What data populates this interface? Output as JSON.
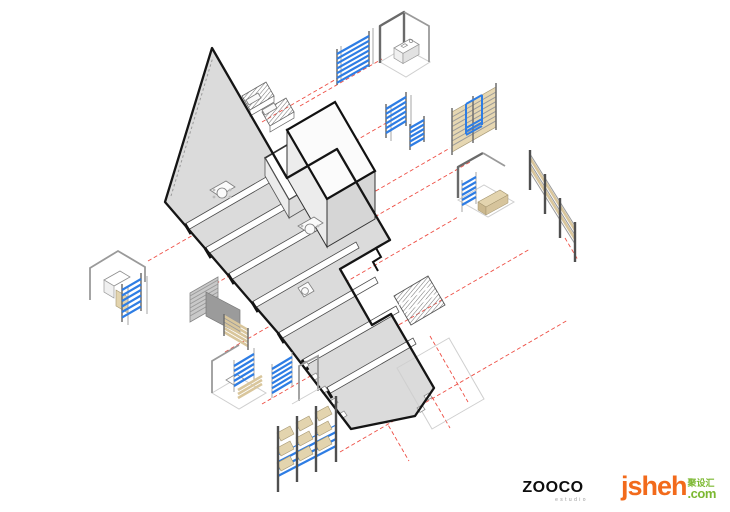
{
  "diagram": {
    "type": "exploded-axonometric-floor-plan",
    "connector_style": "red-dashed",
    "items": [
      "kitchen-corner-unit",
      "blue-shelf-top",
      "blue-shelf-mid",
      "blue-shelf-mid-small",
      "tan-wardrobe-unit",
      "corner-bench-unit",
      "long-tan-partition",
      "corner-shelf-left",
      "gray-slatted-panel",
      "corner-unit-lower",
      "blue-frame-shelf",
      "display-rack-bottom",
      "building-plan",
      "terrace-outline"
    ]
  },
  "colors": {
    "accent_red": "#ee4f45",
    "shelf_blue": "#2e7de4",
    "wood_tan": "#e3d4ae",
    "floor_gray": "#dbdbdb",
    "outline_black": "#151515"
  },
  "logos": {
    "zooco": {
      "name": "ZOOCO",
      "subtitle": "estudio"
    },
    "jsheh": {
      "brand": "jsheh",
      "cjk": "聚设汇",
      "tld": ".com"
    }
  }
}
